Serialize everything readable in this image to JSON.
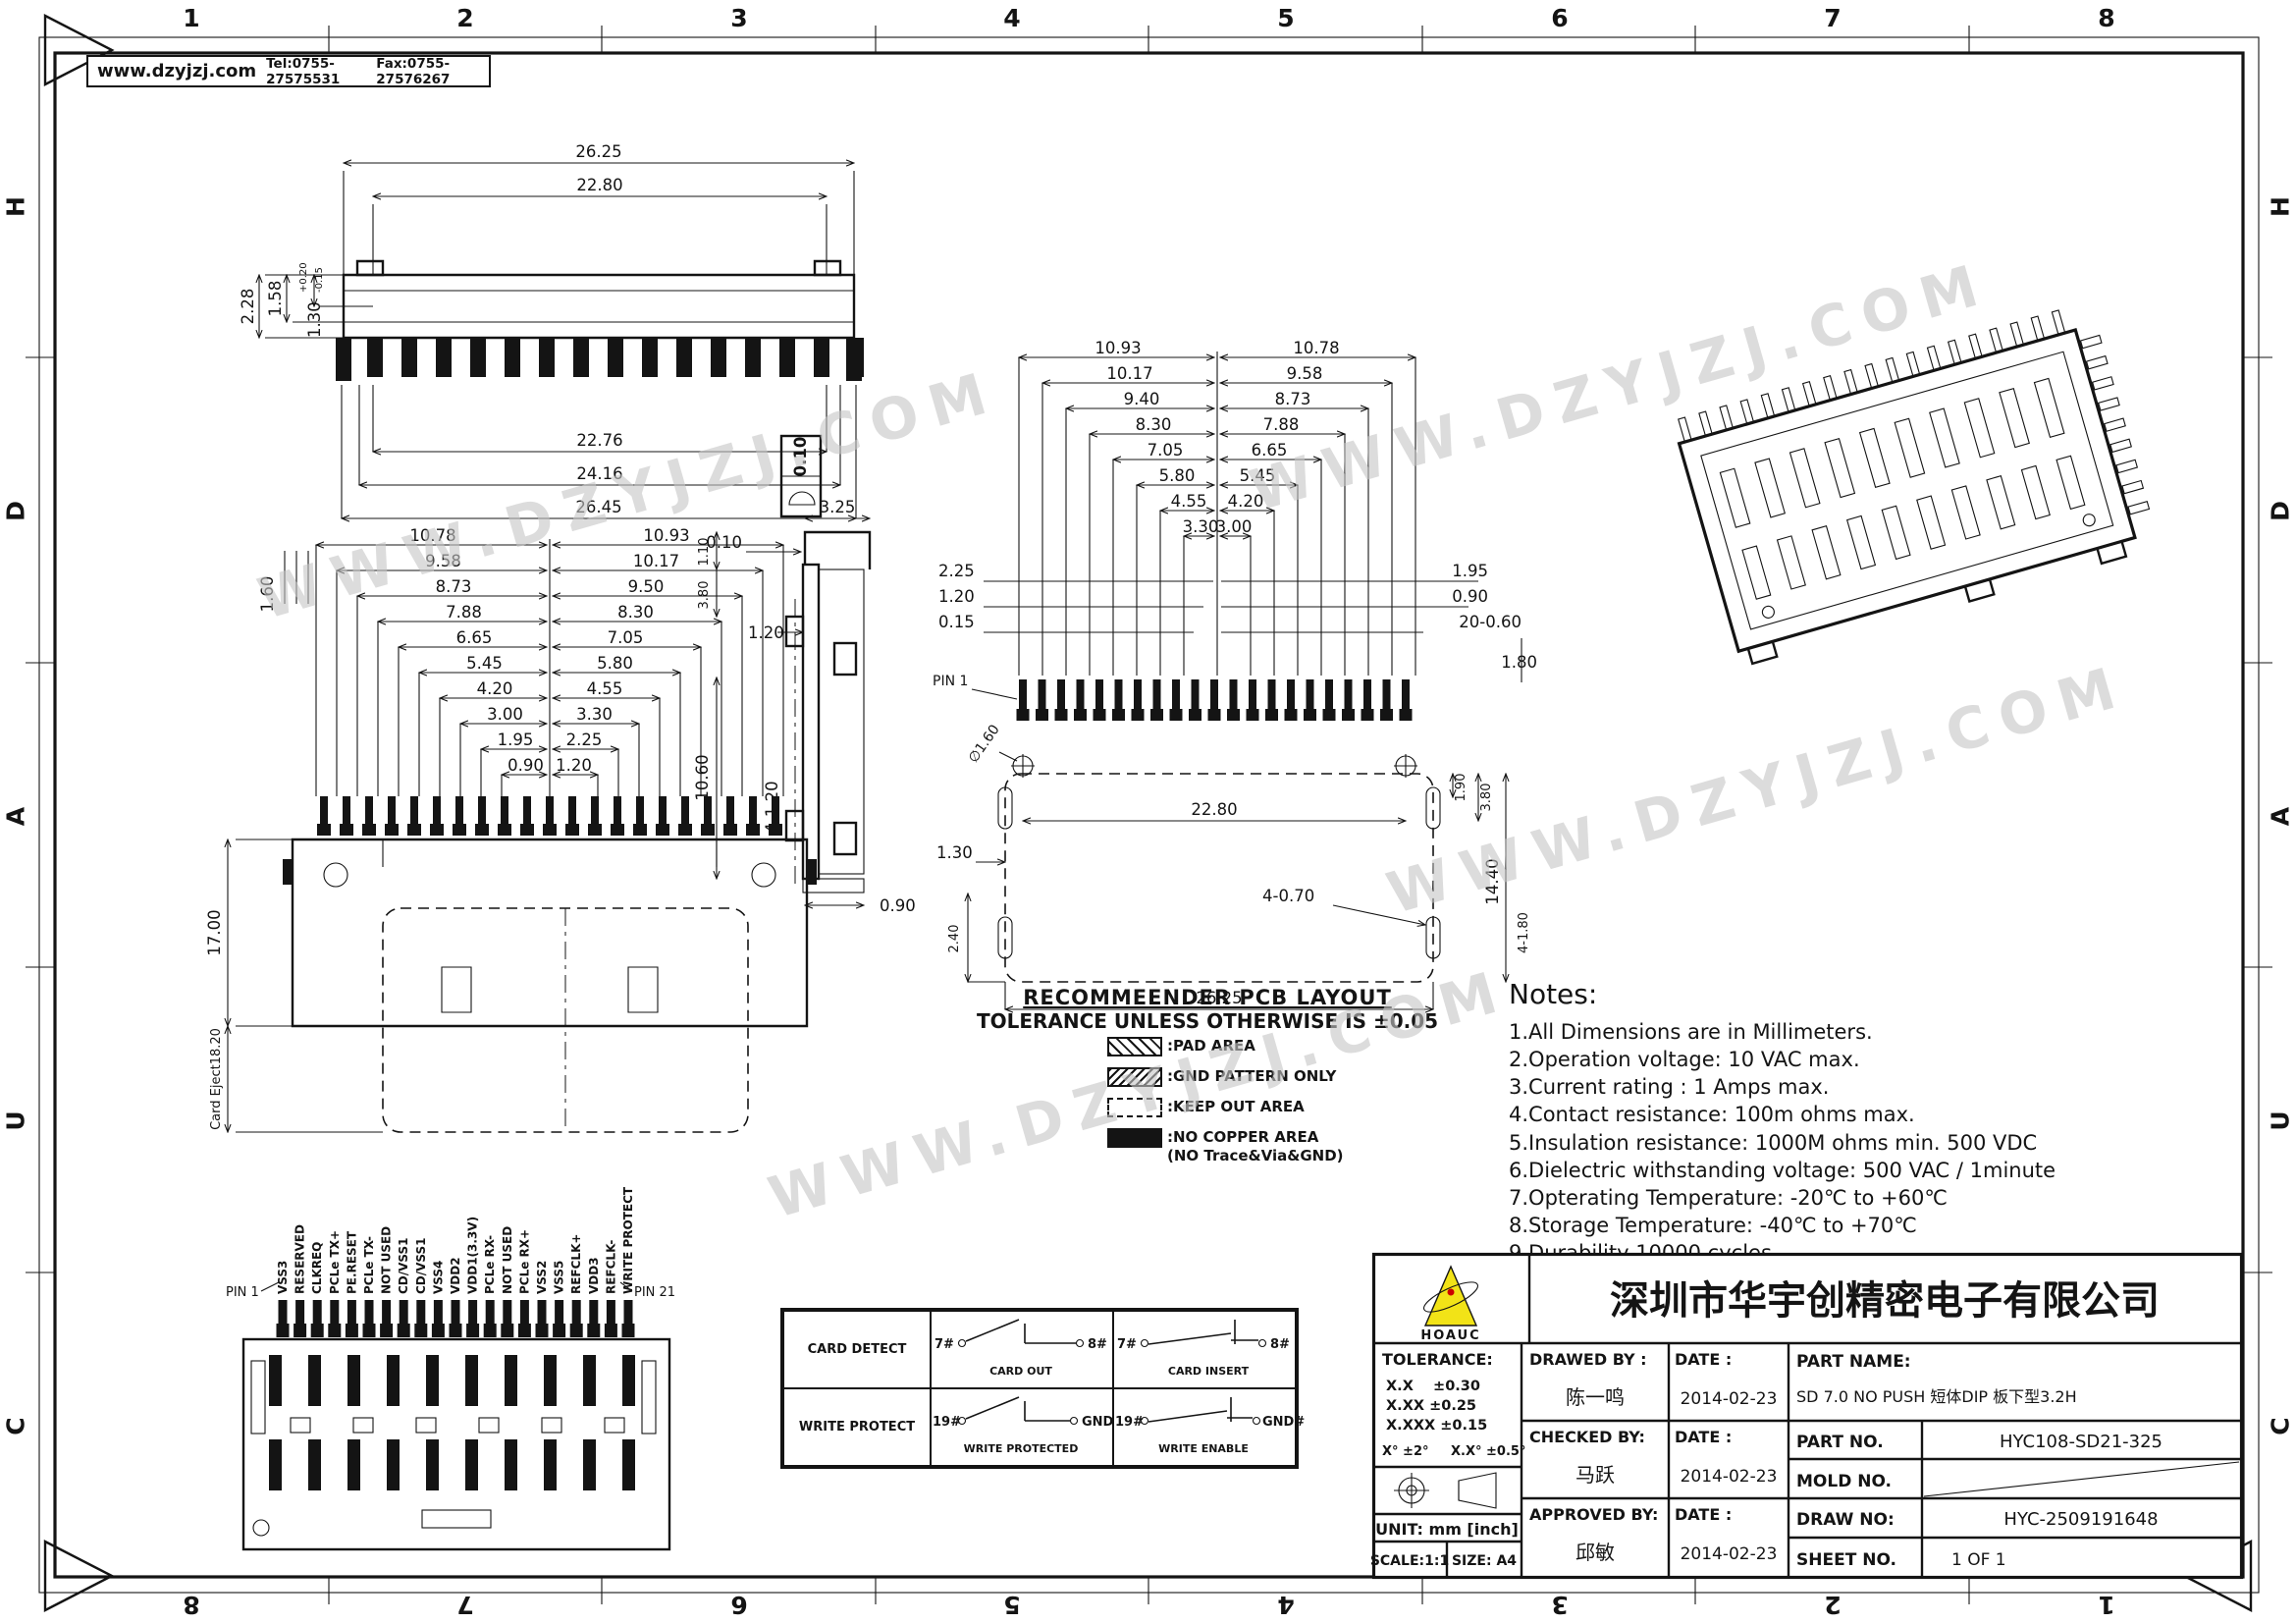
{
  "header": {
    "website": "www.dzyjzj.com",
    "tel": "Tel:0755-27575531",
    "fax": "Fax:0755-27576267"
  },
  "frame": {
    "cols": [
      "1",
      "2",
      "3",
      "4",
      "5",
      "6",
      "7",
      "8"
    ],
    "rows": [
      "H",
      "D",
      "A",
      "U",
      "C"
    ]
  },
  "watermark": {
    "text": "WWW.DZYJZJ.COM"
  },
  "views": {
    "top": {
      "a1": "26.25",
      "a2": "22.80",
      "b1": "22.76",
      "b2": "24.16",
      "b3": "26.45",
      "l1": "2.28",
      "l2": "1.58",
      "l3": "1.30",
      "l3a": "+0.20",
      "l3b": "-0.15"
    },
    "front": {
      "ladder_left": [
        "10.78",
        "9.58",
        "8.73",
        "7.88",
        "6.65",
        "5.45",
        "4.20",
        "3.00",
        "1.95",
        "0.90"
      ],
      "ladder_right": [
        "10.93",
        "10.17",
        "9.50",
        "8.30",
        "7.05",
        "5.80",
        "4.55",
        "3.30",
        "2.25",
        "1.20"
      ],
      "pitch": "1.60",
      "height": "17.00",
      "eject": "Card Eject18.20"
    },
    "side": {
      "fcf": "0.10",
      "d1": "3.25",
      "d2": "0.10",
      "d3": "1.10",
      "d4": "1.20",
      "d5": "3.80",
      "d6": "10.60",
      "d7": "4-1.20",
      "d8": "0.90"
    },
    "pcb": {
      "ladder_left": [
        "10.93",
        "10.17",
        "9.40",
        "8.30",
        "7.05",
        "5.80",
        "4.55",
        "3.30"
      ],
      "ladder_right": [
        "10.78",
        "9.58",
        "8.73",
        "7.88",
        "6.65",
        "5.45",
        "4.20",
        "3.00"
      ],
      "left_stack": [
        "2.25",
        "1.20",
        "0.15"
      ],
      "right_stack": [
        "1.95",
        "0.90",
        "20-0.60",
        "1.80"
      ],
      "pin1": "PIN 1",
      "dia": "∅1.60",
      "w_in": "22.80",
      "r1": "1.90",
      "r2": "3.80",
      "r3": "14.40",
      "slot_b": "4-0.70",
      "w_out": "26.25",
      "l1": "1.30",
      "l2": "2.40",
      "slot_r": "4-1.80",
      "title": "RECOMMEENDER PCB LAYOUT",
      "tol": "TOLERANCE UNLESS OTHERWISE IS ±0.05",
      "legend": [
        {
          "label": ":PAD AREA"
        },
        {
          "label": ":GND PATTERN ONLY"
        },
        {
          "label": ":KEEP OUT AREA"
        },
        {
          "label": ":NO COPPER AREA",
          "label2": "(NO Trace&Via&GND)"
        }
      ]
    },
    "bottom": {
      "pin1": "PIN 1",
      "pin21": "PIN 21",
      "pin_labels": [
        "VSS3",
        "RESERVED",
        "CLKREQ",
        "PCLe TX+",
        "PE.RESET",
        "PCLe TX-",
        "NOT USED",
        "CD/VSS1",
        "CD/VSS1",
        "VSS4",
        "VDD2",
        "VDD1(3.3V)",
        "PCLe RX-",
        "NOT USED",
        "PCLe RX+",
        "VSS2",
        "VSS5",
        "REFCLK+",
        "VDD3",
        "REFCLK-",
        "WRITE PROTECT"
      ]
    },
    "switch_table": {
      "rows": [
        {
          "name": "CARD DETECT",
          "cells": [
            {
              "from": "7#",
              "to": "8#",
              "caption": "CARD OUT"
            },
            {
              "from": "7#",
              "to": "8#",
              "caption": "CARD INSERT"
            }
          ]
        },
        {
          "name": "WRITE PROTECT",
          "cells": [
            {
              "from": "19#",
              "to": "GND",
              "caption": "WRITE PROTECTED"
            },
            {
              "from": "19#",
              "to": "GND#",
              "caption": "WRITE ENABLE"
            }
          ]
        }
      ]
    }
  },
  "notes": {
    "title": "Notes:",
    "items": [
      "1.All Dimensions are in Millimeters.",
      "2.Operation voltage: 10 VAC max.",
      "3.Current rating : 1 Amps max.",
      "4.Contact resistance: 100m ohms max.",
      "5.Insulation resistance: 1000M ohms min.  500 VDC",
      "6.Dielectric withstanding voltage: 500 VAC / 1minute",
      "7.Opterating Temperature: -20℃ to +60℃",
      "8.Storage Temperature: -40℃ to +70℃",
      "9.Durability 10000 cycles."
    ]
  },
  "title_block": {
    "company": "深圳市华宇创精密电子有限公司",
    "logo_text": "HOAUC",
    "tolerance_label": "TOLERANCE:",
    "tol1": "X.X    ±0.30",
    "tol2": "X.XX   ±0.25",
    "tol3": "X.XXX ±0.15",
    "tol4": "X°  ±2°",
    "tol5": "X.X°  ±0.5°",
    "unit": "UNIT: mm [inch]",
    "scale": "SCALE:1:1",
    "size": "SIZE: A4",
    "drawed_label": "DRAWED BY :",
    "date_label": "DATE :",
    "drawed_name": "陈一鸣",
    "drawed_date": "2014-02-23",
    "checked_label": "CHECKED BY:",
    "checked_name": "马跃",
    "checked_date": "2014-02-23",
    "approved_label": "APPROVED BY:",
    "approved_name": "邱敏",
    "approved_date": "2014-02-23",
    "part_name_label": "PART NAME:",
    "part_name": "SD 7.0 NO PUSH 短体DIP 板下型3.2H",
    "part_no_label": "PART NO.",
    "part_no": "HYC108-SD21-325",
    "mold_label": "MOLD NO.",
    "draw_no_label": "DRAW NO:",
    "draw_no": "HYC-2509191648",
    "sheet_label": "SHEET NO.",
    "sheet": "1 OF 1"
  }
}
